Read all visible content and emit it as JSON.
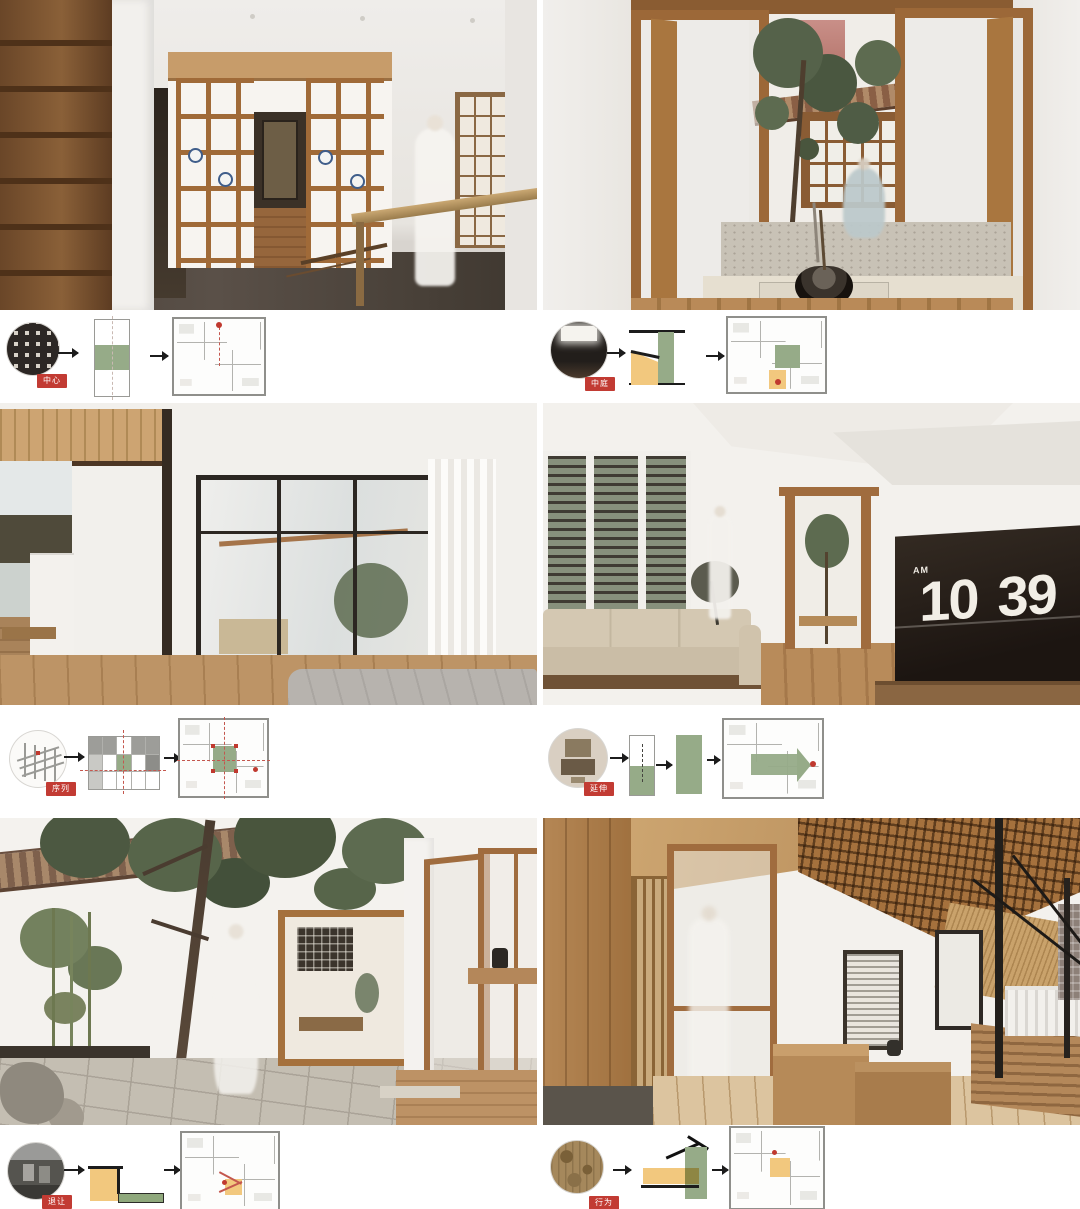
{
  "colors": {
    "accent_green": "#96AB88",
    "accent_yellow": "#F2C87E",
    "badge_red": "#C23B33",
    "marker_red": "#C0392F",
    "wood": "#A5713D",
    "ink": "#1C1C1C",
    "plan_wall_gray": "#B3B3AF"
  },
  "clock": {
    "meridiem": "AM",
    "hours": "10",
    "minutes": "39"
  },
  "concepts": [
    {
      "badge": "中心",
      "thumb_icon": "dark-facade-photo",
      "diagram_icon": "bar-with-central-green-band",
      "plan_icon": "floor-plan-red-focus-dot"
    },
    {
      "badge": "中庭",
      "thumb_icon": "dark-interior-photo",
      "diagram_icon": "section-wedge-yellow-green",
      "plan_icon": "floor-plan-green-zone-yellow-court"
    },
    {
      "badge": "序列",
      "thumb_icon": "axonometric-line-drawing",
      "diagram_icon": "nine-grid-green-center",
      "plan_icon": "floor-plan-green-center-cross-axes"
    },
    {
      "badge": "延伸",
      "thumb_icon": "model-top-view-photo",
      "diagram_icon": "half-green-to-full-green-bars",
      "plan_icon": "floor-plan-green-arrow-east"
    },
    {
      "badge": "退让",
      "thumb_icon": "street-photo-bw",
      "diagram_icon": "yellow-block-green-ledge",
      "plan_icon": "floor-plan-yellow-notch-red-dot"
    },
    {
      "badge": "行为",
      "thumb_icon": "antique-map-photo",
      "diagram_icon": "roof-section-green-yellow",
      "plan_icon": "floor-plan-yellow-room-red-dot"
    }
  ],
  "renders": [
    {
      "name": "display-lattice-tea-room"
    },
    {
      "name": "courtyard-atrium-tree"
    },
    {
      "name": "bedroom-glass-partition"
    },
    {
      "name": "lounge-flip-clock"
    },
    {
      "name": "tree-courtyard"
    },
    {
      "name": "timber-loft-terrace"
    }
  ]
}
